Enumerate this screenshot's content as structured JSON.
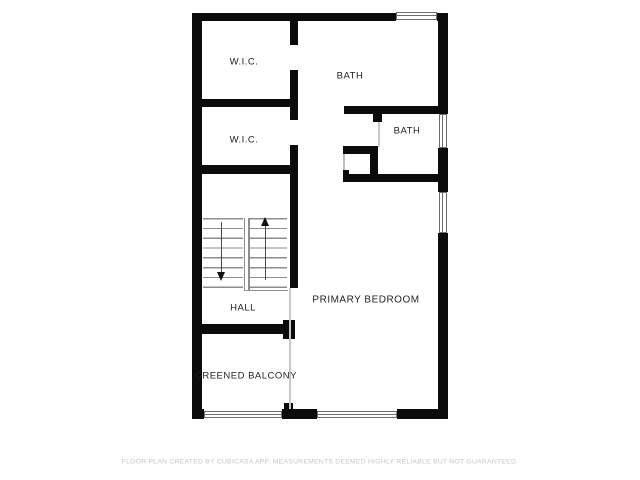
{
  "rooms": {
    "wic_upper": {
      "label": "W.I.C."
    },
    "wic_lower": {
      "label": "W.I.C."
    },
    "bath_upper": {
      "label": "BATH"
    },
    "bath_middle": {
      "label": "BATH"
    },
    "primary_bedroom": {
      "label": "PRIMARY BEDROOM"
    },
    "hall": {
      "label": "HALL"
    },
    "balcony": {
      "label": "CREENED BALCONY"
    }
  },
  "stairs": {
    "up_icon": "up-arrow",
    "down_icon": "down-arrow"
  },
  "icons": {
    "window": "double-line window symbol"
  },
  "footer": {
    "disclaimer": "FLOOR PLAN CREATED BY CUBICASA APP. MEASUREMENTS DEEMED HIGHLY RELIABLE BUT NOT GUARANTEED."
  },
  "colors": {
    "wall": "#0b0b0b",
    "background": "#ffffff",
    "label_text": "#1f1f1f",
    "stair_lines": "#8d8d8d",
    "window_outline": "#6d6d6d",
    "thin_divider": "#c9c9c9",
    "disclaimer_text": "#c6c6c6"
  }
}
